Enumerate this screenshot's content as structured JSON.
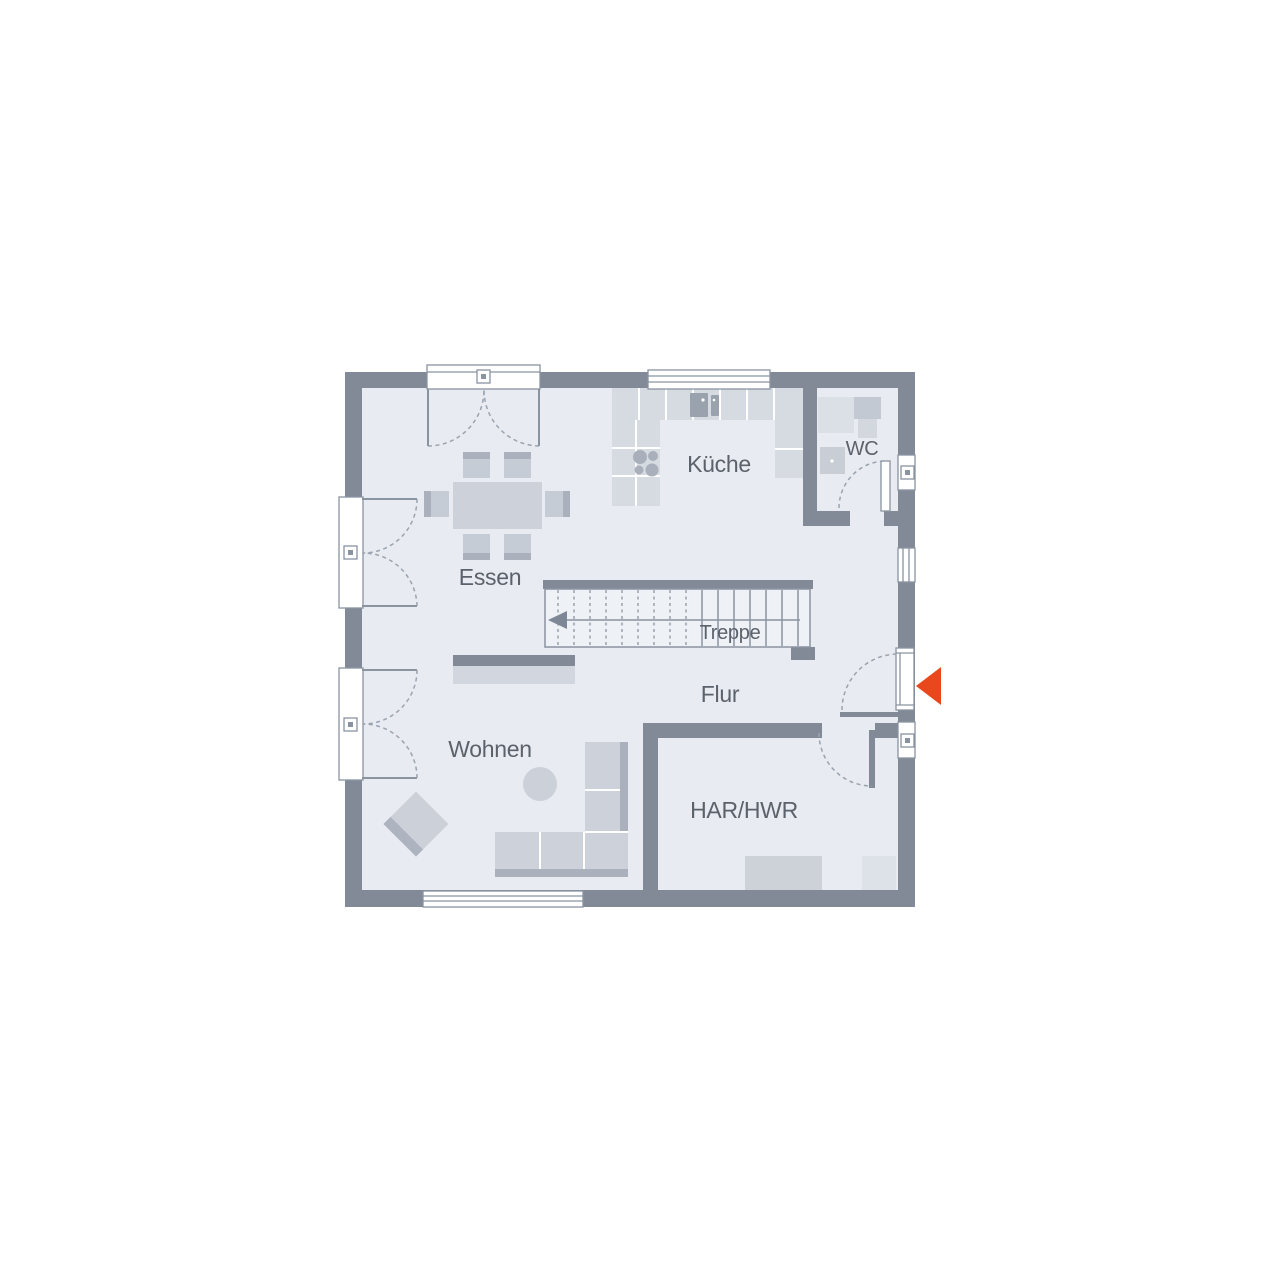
{
  "plan": {
    "type": "floor-plan",
    "level": "ground-floor",
    "rooms": {
      "essen": {
        "label": "Essen"
      },
      "kueche": {
        "label": "Küche"
      },
      "wc": {
        "label": "WC"
      },
      "treppe": {
        "label": "Treppe"
      },
      "flur": {
        "label": "Flur"
      },
      "wohnen": {
        "label": "Wohnen"
      },
      "har_hwr": {
        "label": "HAR/HWR"
      }
    },
    "entrance": {
      "symbol": "arrow-left",
      "color": "#e8481c"
    },
    "colors": {
      "wall": "#828a97",
      "floor": "#e8ebf1",
      "furniture": "#cdd2da",
      "furniture_accent": "#aab1bc",
      "line": "#8a93a0",
      "label_text": "#5b626c",
      "background": "#ffffff"
    }
  }
}
